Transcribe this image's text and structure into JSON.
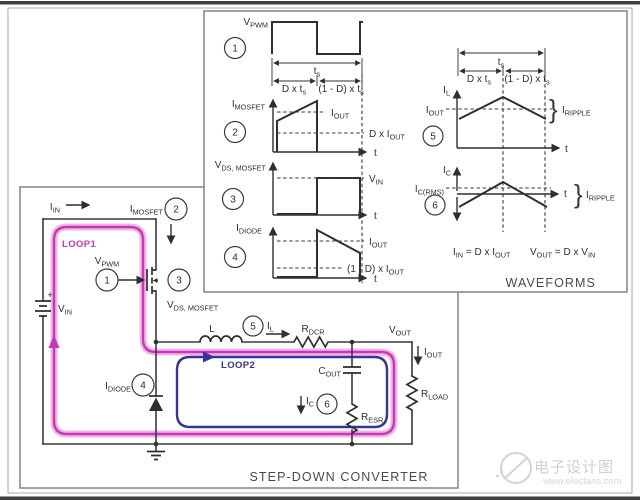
{
  "badges": [
    "1",
    "2",
    "3",
    "4",
    "5",
    "6"
  ],
  "glyphs": {
    "brace": "}",
    "plus": "+"
  },
  "waveforms": {
    "title": "WAVEFORMS",
    "vpwm": "V_{PWM}",
    "ts": "t_{s}",
    "d_ts": "D x t_{s}",
    "one_minus_d_ts": "(1 - D) x t_{s}",
    "imosfet": "I_{MOSFET}",
    "iout": "I_{OUT}",
    "d_iout": "D x I_{OUT}",
    "vds_mosfet": "V_{DS, MOSFET}",
    "vin": "V_{IN}",
    "idiode": "I_{DIODE}",
    "one_minus_d_iout": "(1 - D) x I_{OUT}",
    "il": "I_{L}",
    "ic": "I_{C}",
    "icrms": "I_{C(RMS)}",
    "iripple": "I_{RIPPLE}",
    "t": "t",
    "eq_iin": "I_{IN} = D x I_{OUT}",
    "eq_vout": "V_{OUT} = D x V_{IN}"
  },
  "converter": {
    "title": "STEP-DOWN CONVERTER",
    "iin": "I_{IN}",
    "loop1": "LOOP1",
    "loop2": "LOOP2",
    "vpwm": "V_{PWM}",
    "imosfet": "I_{MOSFET}",
    "vds_mosfet": "V_{DS, MOSFET}",
    "vin": "V_{IN}",
    "inductor": "L",
    "il": "I_{L}",
    "rdcr": "R_{DCR}",
    "vout": "V_{OUT}",
    "iout": "I_{OUT}",
    "rload": "R_{LOAD}",
    "cout": "C_{OUT}",
    "ic": "I_{C}",
    "resr": "R_{ESR}",
    "idiode": "I_{DIODE}"
  },
  "watermark": {
    "brand": "电子设计图",
    "site": "www.elecfans.com"
  },
  "colors": {
    "loop1": "#c737b8",
    "loop1_glow": "#f0b6e6",
    "loop2": "#333399",
    "wire": "#3a3a3a",
    "panel_border": "#8a8a8a",
    "text": "#2e2e2e",
    "watermark": "#d0d0d0"
  }
}
